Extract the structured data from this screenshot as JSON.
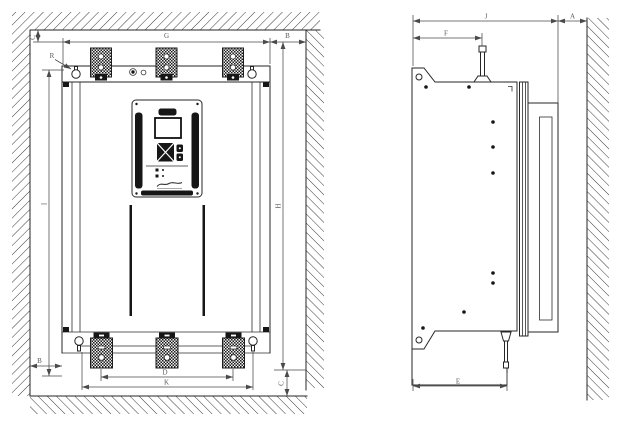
{
  "drawing": {
    "front_view": {
      "label_top_clearance": "C",
      "label_mounting_width": "G",
      "label_right_clearance": "B",
      "label_mounting_slot": "R",
      "label_mounting_height": "I",
      "label_overall_height": "H",
      "label_left_clearance": "B",
      "label_terminal_pitch_inner": "D",
      "label_terminal_pitch_outer": "K",
      "label_bottom_clearance": "C"
    },
    "side_view": {
      "label_overall_depth": "J",
      "label_front_clearance": "A",
      "label_top_depth": "F",
      "label_base_depth": "E"
    },
    "colors": {
      "line": "#262626",
      "dimension": "#4a4a4a",
      "label": "#5a5a5a",
      "background": "#ffffff"
    }
  }
}
